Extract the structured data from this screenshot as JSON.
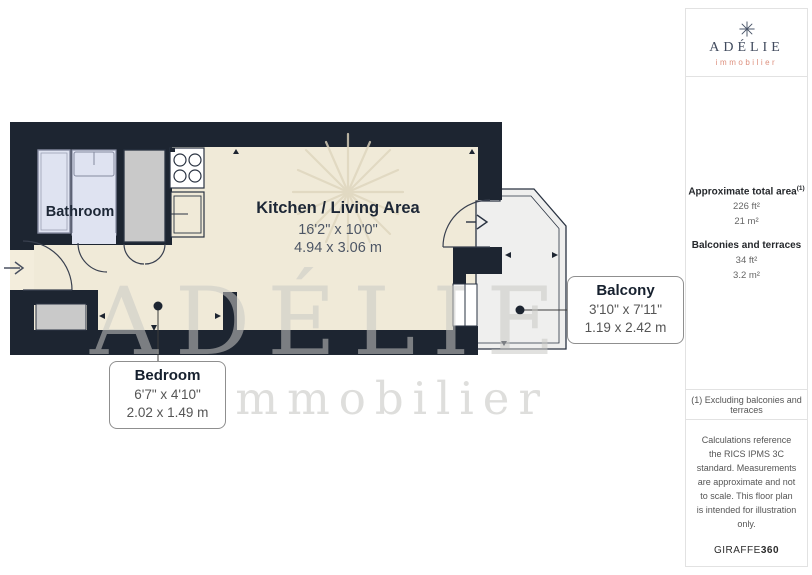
{
  "branding": {
    "name": "ADÉLIE",
    "tagline": "immobilier"
  },
  "sidebar": {
    "stats": {
      "total_area_label": "Approximate total area",
      "total_area_sup": "(1)",
      "total_area_imperial": "226 ft²",
      "total_area_metric": "21 m²",
      "balconies_label": "Balconies and terraces",
      "balconies_imperial": "34 ft²",
      "balconies_metric": "3.2 m²"
    },
    "footnote": "(1) Excluding balconies and terraces",
    "disclaimer": "Calculations reference the RICS IPMS 3C standard. Measurements are approximate and not to scale. This floor plan is intended for illustration only.",
    "provider_name": "GIRAFFE",
    "provider_suffix": "360"
  },
  "floorplan": {
    "bathroom": {
      "label": "Bathroom"
    },
    "kitchen_living": {
      "label": "Kitchen / Living Area",
      "dims_imperial": "16'2\" x 10'0\"",
      "dims_metric": "4.94 x 3.06 m"
    },
    "bedroom": {
      "label": "Bedroom",
      "dims_imperial": "6'7\" x 4'10\"",
      "dims_metric": "2.02 x 1.49 m"
    },
    "balcony": {
      "label": "Balcony",
      "dims_imperial": "3'10\" x 7'11\"",
      "dims_metric": "1.19 x 2.42 m"
    },
    "watermark": {
      "name": "ADÉLIE",
      "tagline": "immobilier"
    }
  },
  "colors": {
    "wall": "#1d2531",
    "floor": "#f0ead8",
    "fixture": "#dfe3f1",
    "wardrobe": "#c9c9c9",
    "balcony": "#efefee",
    "navy": "#414b5e",
    "salmon": "#dd8f7d"
  }
}
